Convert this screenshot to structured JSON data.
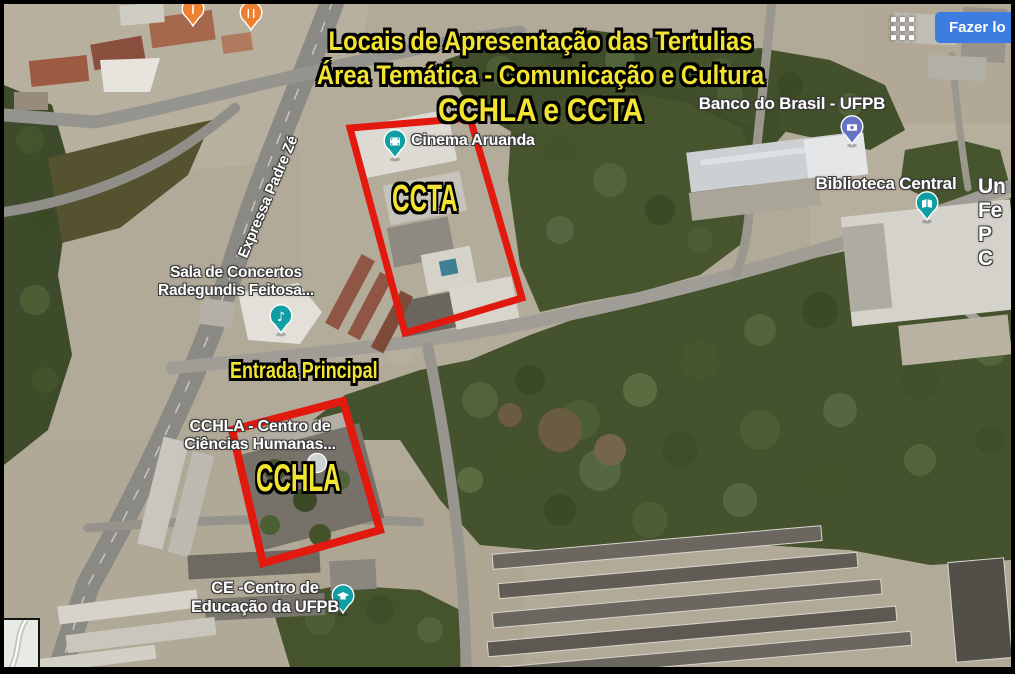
{
  "title_overlay": {
    "line1": "Locais de Apresentação das Tertulias",
    "line2": "Área Temática - Comunicação e Cultura",
    "line3": "CCHLA e CCTA",
    "text_color": "#f2e431"
  },
  "annotations": {
    "ccta_box_label": "CCTA",
    "cchla_box_label": "CCHLA",
    "entrada_label": "Entrada Principal",
    "highlight_color": "#e2190f"
  },
  "map_labels": {
    "cinema": "Cinema Aruanda",
    "banco": "Banco do Brasil - UFPB",
    "biblioteca": "Biblioteca Central",
    "sala_concertos": {
      "line1": "Sala de Concertos",
      "line2": "Radegundis Feitosa..."
    },
    "cchla_poi": {
      "line1": "CCHLA - Centro de",
      "line2": "Ciências Humanas..."
    },
    "ce_poi": {
      "line1": "CE -Centro de",
      "line2": "Educação da UFPB"
    },
    "road": "Expressa Padre Zé",
    "university_truncated": [
      "Un",
      "Fe",
      "P",
      "C"
    ]
  },
  "topbar": {
    "login_button_label": "Fazer lo",
    "login_button_color": "#3d7de2",
    "apps_grid_icon": "google-apps-grid-icon"
  },
  "pins": {
    "teal": "#0f9ea3",
    "indigo": "#6673c4",
    "orange": "#ee8033",
    "gray": "#ccd2d0",
    "cinema_icon": "film-icon",
    "bank_icon": "banknote-icon",
    "library_icon": "open-book-icon",
    "music_icon": "music-note-icon",
    "education_icon": "graduation-cap-icon",
    "restaurant_icon": "fork-knife-icon",
    "poi_icon": "pole-icon"
  }
}
